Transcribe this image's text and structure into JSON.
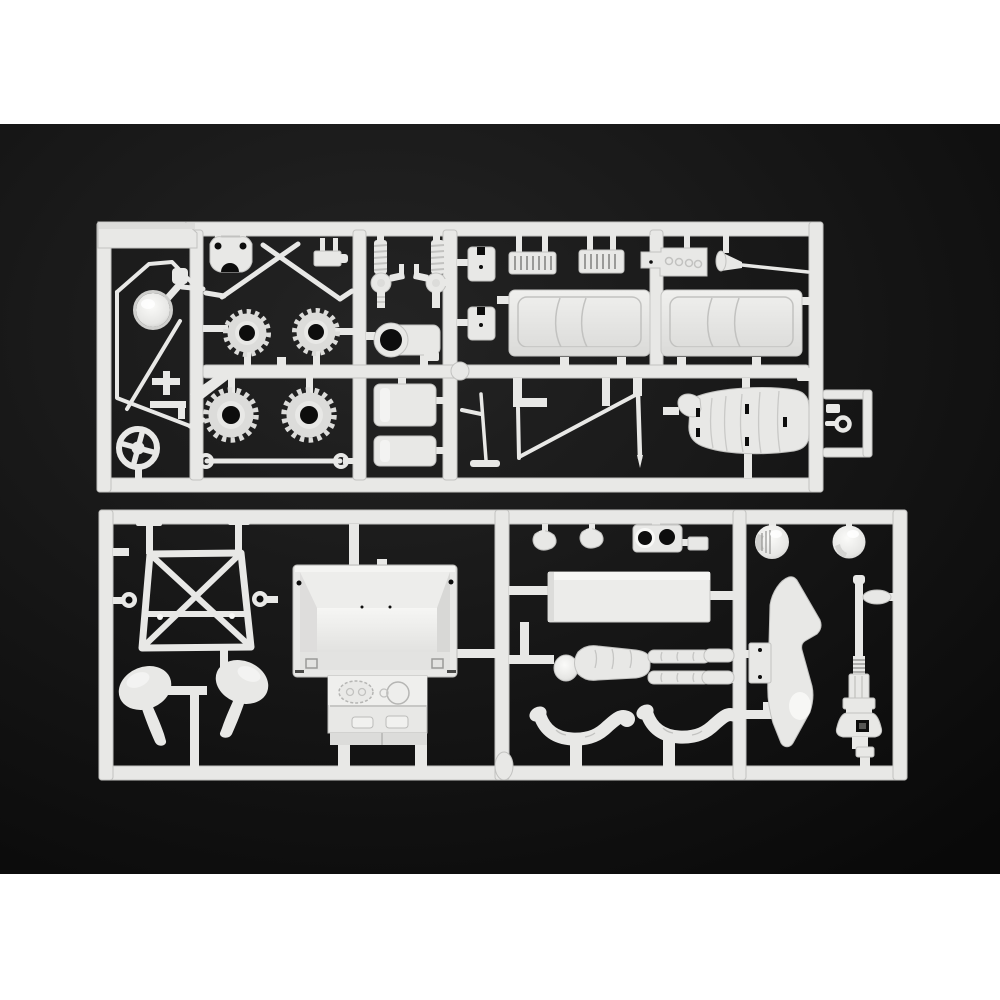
{
  "scene": {
    "description": "Product photo of two white injection-molded model kit part sprues (runners) laid on a black backdrop, with white bands above and below the photo area",
    "photo_subject": "model-kit-plastic-sprues",
    "text_content": "none",
    "colors": {
      "band": "#ffffff",
      "backdrop": "#141414",
      "backdrop_corner": "#0a0a0a",
      "plastic": "#e8e8e6",
      "plastic_mid": "#dcdcda",
      "plastic_shade": "#c2c2c0",
      "plastic_bright": "#f8f8f6",
      "hole": "#0d0d0d"
    },
    "layout": {
      "image_size": 1000,
      "top_band_bottom": 124,
      "photo_bottom": 874
    }
  },
  "sprues": [
    {
      "id": "upper",
      "position": "top",
      "parts": [
        "windscreen-frame",
        "headlight-dome",
        "small-brackets",
        "steering-wheel",
        "suspension-bracket",
        "crossed-tie-rods",
        "small-engine-block",
        "gear-wheel-x4",
        "tie-bar-rod",
        "coil-spring-damper-x2",
        "gearbox-housing",
        "fuel-tank-x2",
        "mounting-plate-x2",
        "radiator-grille-x2",
        "carburetor-block",
        "intake-funnel-rod",
        "engine-cover-panel-x2",
        "roll-cage-braces",
        "bucket-seat",
        "tow-ring"
      ]
    },
    {
      "id": "lower",
      "position": "bottom",
      "parts": [
        "chassis-sub-frame",
        "fender-shell-x2",
        "cockpit-tub-dashboard",
        "pedal-part-x2",
        "lamp-pod-plate",
        "driver-helmet-x2",
        "floor-panel",
        "driver-figure",
        "driver-arm-x2",
        "side-body-panel",
        "fuel-filler-pump",
        "sprue-boss"
      ]
    }
  ]
}
